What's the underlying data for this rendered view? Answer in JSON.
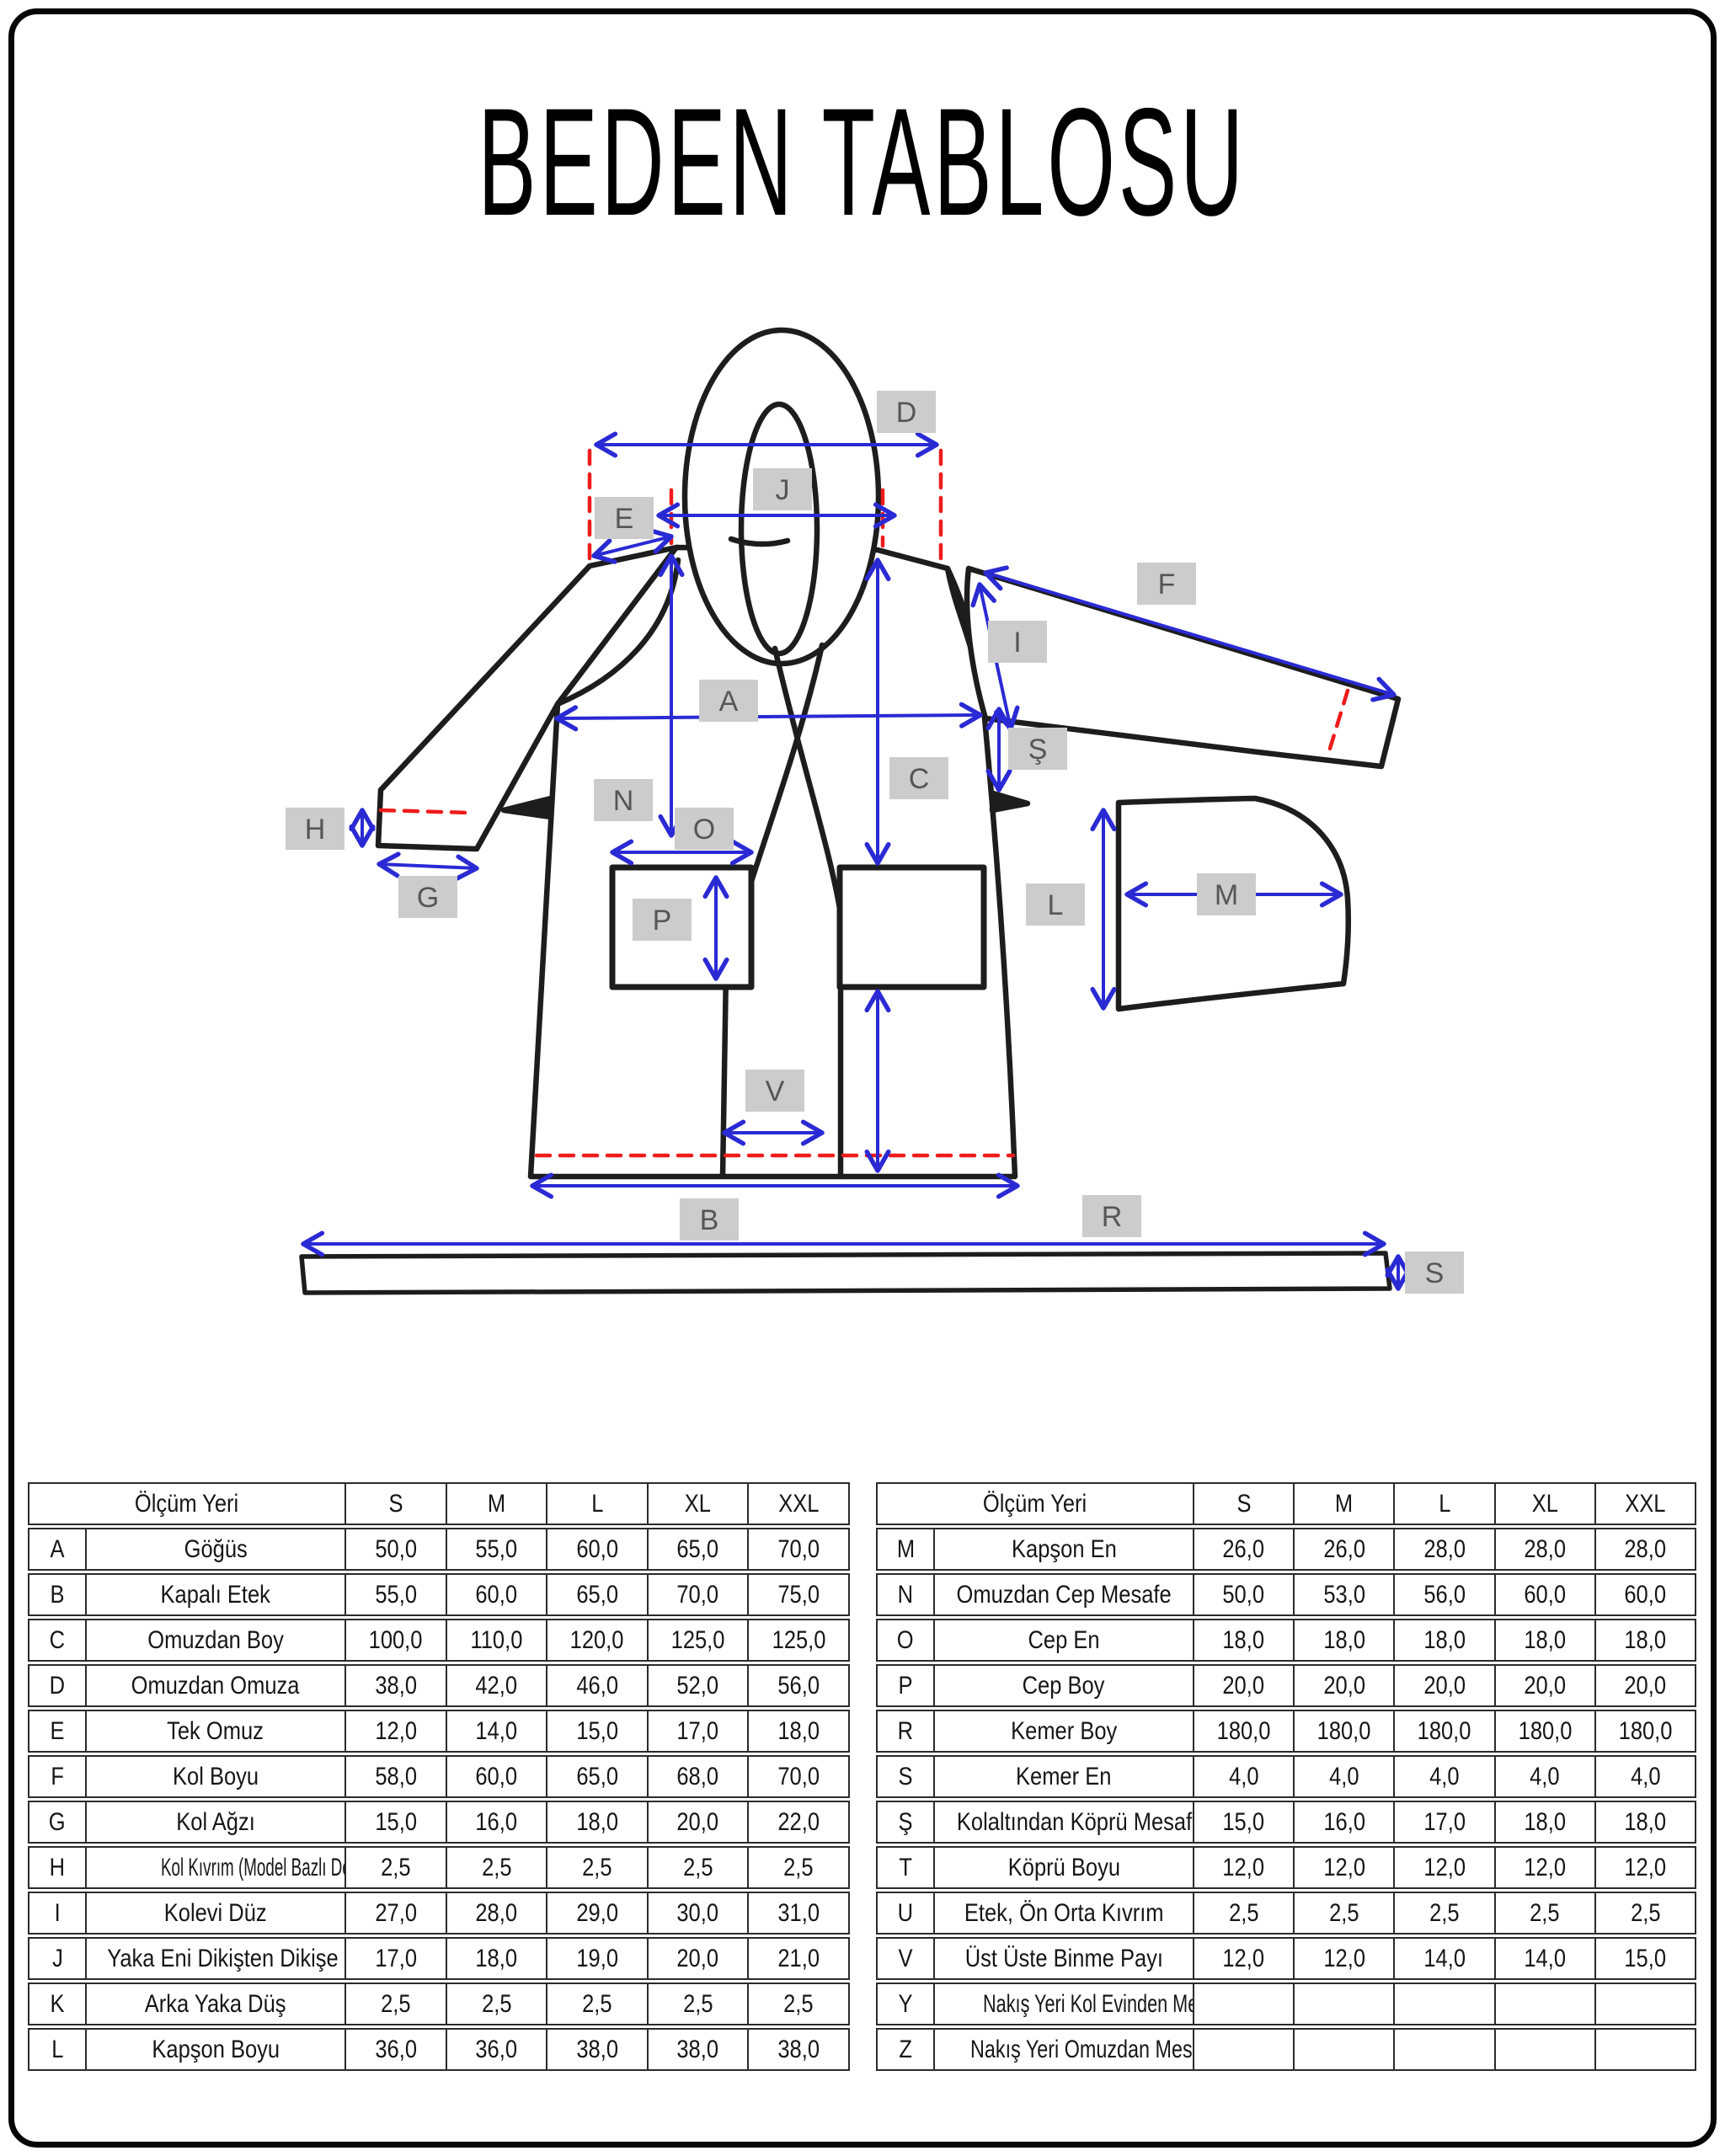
{
  "title": "BEDEN TABLOSU",
  "colors": {
    "accent-blue": "#2a2ad4",
    "accent-red": "#ee1b1b",
    "label-bg": "#cccccc",
    "label-fg": "#565656",
    "line": "#1d1d1d",
    "table-border": "#2b2b2b"
  },
  "diagram": {
    "labels": [
      "D",
      "J",
      "E",
      "F",
      "I",
      "A",
      "Ş",
      "C",
      "N",
      "H",
      "G",
      "O",
      "P",
      "L",
      "M",
      "V",
      "B",
      "R",
      "S"
    ]
  },
  "left_table": {
    "header": {
      "measure": "Ölçüm Yeri",
      "sizes": [
        "S",
        "M",
        "L",
        "XL",
        "XXL"
      ]
    },
    "rows": [
      {
        "code": "A",
        "name": "Göğüs",
        "values": [
          "50,0",
          "55,0",
          "60,0",
          "65,0",
          "70,0"
        ]
      },
      {
        "code": "B",
        "name": "Kapalı Etek",
        "values": [
          "55,0",
          "60,0",
          "65,0",
          "70,0",
          "75,0"
        ]
      },
      {
        "code": "C",
        "name": "Omuzdan Boy",
        "values": [
          "100,0",
          "110,0",
          "120,0",
          "125,0",
          "125,0"
        ]
      },
      {
        "code": "D",
        "name": "Omuzdan Omuza",
        "values": [
          "38,0",
          "42,0",
          "46,0",
          "52,0",
          "56,0"
        ]
      },
      {
        "code": "E",
        "name": "Tek Omuz",
        "values": [
          "12,0",
          "14,0",
          "15,0",
          "17,0",
          "18,0"
        ]
      },
      {
        "code": "F",
        "name": "Kol Boyu",
        "values": [
          "58,0",
          "60,0",
          "65,0",
          "68,0",
          "70,0"
        ]
      },
      {
        "code": "G",
        "name": "Kol Ağzı",
        "values": [
          "15,0",
          "16,0",
          "18,0",
          "20,0",
          "22,0"
        ]
      },
      {
        "code": "H",
        "name": "Kol Kıvrım (Model Bazlı Değişebilir)",
        "values": [
          "2,5",
          "2,5",
          "2,5",
          "2,5",
          "2,5"
        ]
      },
      {
        "code": "I",
        "name": "Kolevi Düz",
        "values": [
          "27,0",
          "28,0",
          "29,0",
          "30,0",
          "31,0"
        ]
      },
      {
        "code": "J",
        "name": "Yaka Eni Dikişten Dikişe",
        "values": [
          "17,0",
          "18,0",
          "19,0",
          "20,0",
          "21,0"
        ]
      },
      {
        "code": "K",
        "name": "Arka Yaka Düş",
        "values": [
          "2,5",
          "2,5",
          "2,5",
          "2,5",
          "2,5"
        ]
      },
      {
        "code": "L",
        "name": "Kapşon Boyu",
        "values": [
          "36,0",
          "36,0",
          "38,0",
          "38,0",
          "38,0"
        ]
      }
    ]
  },
  "right_table": {
    "header": {
      "measure": "Ölçüm Yeri",
      "sizes": [
        "S",
        "M",
        "L",
        "XL",
        "XXL"
      ]
    },
    "rows": [
      {
        "code": "M",
        "name": "Kapşon En",
        "values": [
          "26,0",
          "26,0",
          "28,0",
          "28,0",
          "28,0"
        ]
      },
      {
        "code": "N",
        "name": "Omuzdan Cep Mesafe",
        "values": [
          "50,0",
          "53,0",
          "56,0",
          "60,0",
          "60,0"
        ]
      },
      {
        "code": "O",
        "name": "Cep En",
        "values": [
          "18,0",
          "18,0",
          "18,0",
          "18,0",
          "18,0"
        ]
      },
      {
        "code": "P",
        "name": "Cep Boy",
        "values": [
          "20,0",
          "20,0",
          "20,0",
          "20,0",
          "20,0"
        ]
      },
      {
        "code": "R",
        "name": "Kemer Boy",
        "values": [
          "180,0",
          "180,0",
          "180,0",
          "180,0",
          "180,0"
        ]
      },
      {
        "code": "S",
        "name": "Kemer En",
        "values": [
          "4,0",
          "4,0",
          "4,0",
          "4,0",
          "4,0"
        ]
      },
      {
        "code": "Ş",
        "name": "Kolaltından Köprü Mesafe",
        "values": [
          "15,0",
          "16,0",
          "17,0",
          "18,0",
          "18,0"
        ]
      },
      {
        "code": "T",
        "name": "Köprü Boyu",
        "values": [
          "12,0",
          "12,0",
          "12,0",
          "12,0",
          "12,0"
        ]
      },
      {
        "code": "U",
        "name": "Etek, Ön Orta Kıvrım",
        "values": [
          "2,5",
          "2,5",
          "2,5",
          "2,5",
          "2,5"
        ]
      },
      {
        "code": "V",
        "name": "Üst Üste Binme Payı",
        "values": [
          "12,0",
          "12,0",
          "14,0",
          "14,0",
          "15,0"
        ]
      },
      {
        "code": "Y",
        "name": "Nakış Yeri Kol Evinden Mesafe",
        "values": [
          "",
          "",
          "",
          "",
          ""
        ]
      },
      {
        "code": "Z",
        "name": "Nakış Yeri Omuzdan Mesafe",
        "values": [
          "",
          "",
          "",
          "",
          ""
        ]
      }
    ]
  }
}
